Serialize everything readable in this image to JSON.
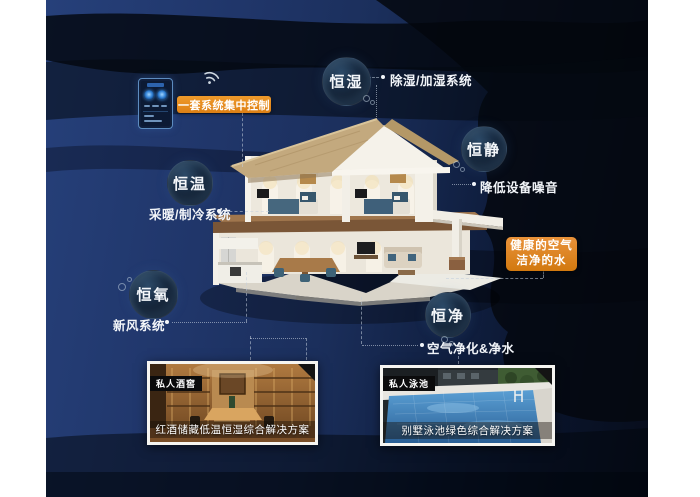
{
  "colors": {
    "accent_orange": "#E2861C",
    "background_navy": "#1F3565"
  },
  "control": {
    "button_label": "一套系统集中控制"
  },
  "nodes": {
    "humidity": {
      "label": "恒湿",
      "note": "除湿/加湿系统"
    },
    "quiet": {
      "label": "恒静",
      "note": "降低设备噪音"
    },
    "temperature": {
      "label": "恒温",
      "note": "采暖/制冷系统"
    },
    "oxygen": {
      "label": "恒氧",
      "note": "新风系统"
    },
    "purity": {
      "label": "恒净",
      "note": "空气净化&净水"
    }
  },
  "highlight": {
    "line1": "健康的空气",
    "line2": "洁净的水"
  },
  "gallery": {
    "wine": {
      "tag": "私人酒窖",
      "caption": "红酒储藏低温恒湿综合解决方案"
    },
    "pool": {
      "tag": "私人泳池",
      "caption": "别墅泳池绿色综合解决方案"
    }
  }
}
